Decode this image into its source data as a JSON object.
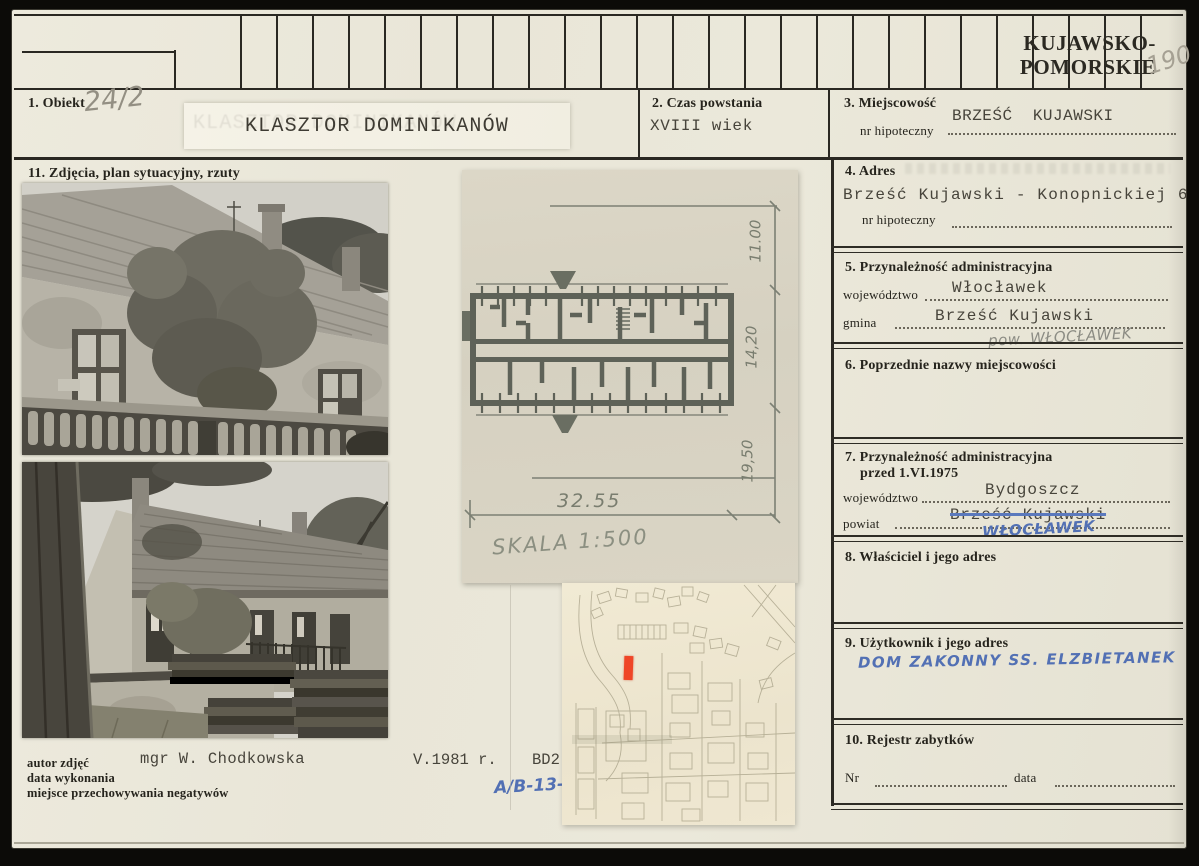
{
  "colors": {
    "pen_blue": "#5270b4",
    "pencil_gray": "#938f83",
    "marker_red": "#ef4627",
    "paper": "#eae7d9"
  },
  "header": {
    "region": "KUJAWSKO-POMORSKIE",
    "page_number": "190"
  },
  "fields": {
    "f1": {
      "label": "1. Obiekt",
      "handwritten": "24/2",
      "title": "KLASZTOR DOMINIKANÓW"
    },
    "f2": {
      "label": "2. Czas powstania",
      "value": "XVIII wiek"
    },
    "f3": {
      "label": "3. Miejscowość",
      "sub_label": "nr hipoteczny",
      "value": "BRZEŚĆ  KUJAWSKI"
    },
    "f4": {
      "label": "4. Adres",
      "value": "Brześć Kujawski - Konopnickiej 6",
      "sub_label": "nr hipoteczny"
    },
    "f5": {
      "label": "5. Przynależność administracyjna",
      "woj_label": "województwo",
      "woj": "Włocławek",
      "gmina_label": "gmina",
      "gmina": "Brześć Kujawski",
      "note": "pow. WŁOCŁAWEK"
    },
    "f6": {
      "label": "6. Poprzednie nazwy miejscowości"
    },
    "f7": {
      "label": "7. Przynależność administracyjna",
      "label2": "przed 1.VI.1975",
      "woj_label": "województwo",
      "woj": "Bydgoszcz",
      "powiat_label": "powiat",
      "powiat_struck": "Brześć Kujawski",
      "powiat_new": "WŁOCŁAWEK"
    },
    "f8": {
      "label": "8. Właściciel i jego adres"
    },
    "f9": {
      "label": "9. Użytkownik i jego adres",
      "value": "DOM ZAKONNY SS. ELZBIETANEK"
    },
    "f10": {
      "label": "10. Rejestr zabytków",
      "nr_label": "Nr",
      "data_label": "data"
    },
    "f11": {
      "label": "11. Zdjęcia, plan sytuacyjny, rzuty"
    }
  },
  "plan": {
    "dim_right_top": "11.00",
    "dim_right_mid": "14,20",
    "dim_right_bottom": "19,50",
    "dim_width": "32.55",
    "scale": "SKALA 1:500"
  },
  "footer": {
    "labels": [
      "autor zdjęć",
      "data wykonania",
      "miejsce przechowywania negatywów"
    ],
    "author": "mgr W. Chodkowska",
    "date": "V.1981 r.",
    "code": "BD2",
    "ref": "A/B-13",
    "ref_suffix": "II"
  }
}
